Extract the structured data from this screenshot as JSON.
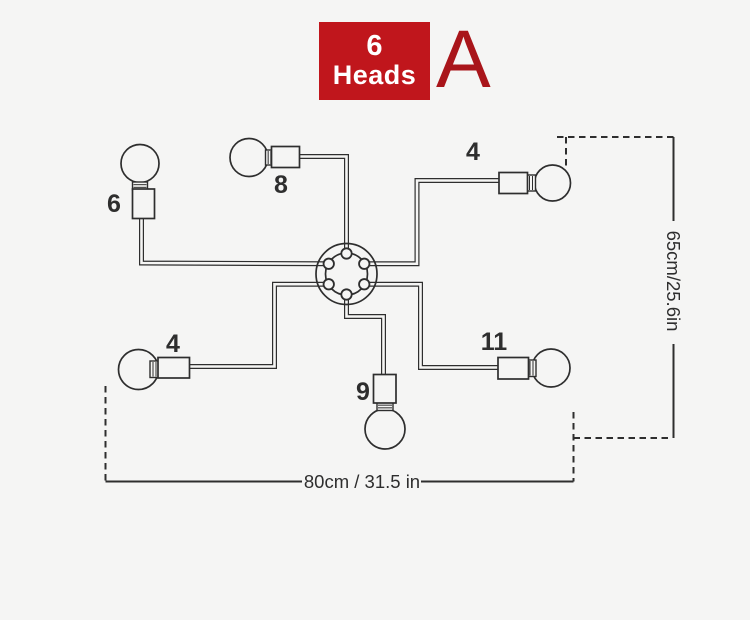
{
  "colors": {
    "background": "#f5f5f4",
    "line": "#2e2e2e",
    "badge_bg": "#c0161c",
    "badge_text": "#ffffff",
    "variant_letter_color": "#a9151a"
  },
  "badge": {
    "count": "6",
    "label": "Heads"
  },
  "variant": {
    "letter": "A"
  },
  "dimensions": {
    "height": {
      "text": "65cm/25.6in"
    },
    "width": {
      "text": "80cm / 31.5 in"
    }
  },
  "diagram": {
    "hub": {
      "cx": 346.5,
      "cy": 274,
      "outer_r": 30.5,
      "inner_r": 21,
      "bolt_ring_r": 20.5,
      "bolt_r": 5.2,
      "bolt_angles_deg": [
        270,
        330,
        30,
        90,
        150,
        210
      ]
    },
    "arms": [
      {
        "label": "6",
        "label_x": 114,
        "label_y": 212,
        "path": [
          [
            141.5,
            217
          ],
          [
            141.5,
            263
          ],
          [
            328.75,
            263.75
          ]
        ],
        "bulb": {
          "cx": 140,
          "cy": 163.5,
          "r": 19
        },
        "neck": {
          "x": 132.5,
          "y": 182,
          "w": 15,
          "h": 8,
          "axis": "v"
        },
        "socket": {
          "x": 132.5,
          "y": 189,
          "w": 22,
          "h": 29.5
        }
      },
      {
        "label": "8",
        "label_x": 281,
        "label_y": 193,
        "path": [
          [
            297,
            156.5
          ],
          [
            346.5,
            156.5
          ],
          [
            346.5,
            253.5
          ]
        ],
        "bulb": {
          "cx": 249,
          "cy": 157.5,
          "r": 19
        },
        "neck": {
          "x": 265.5,
          "y": 150,
          "w": 8,
          "h": 15,
          "axis": "h"
        },
        "socket": {
          "x": 271.5,
          "y": 146.5,
          "w": 28,
          "h": 21
        }
      },
      {
        "label": "4",
        "label_x": 473,
        "label_y": 160,
        "path": [
          [
            364.25,
            263.75
          ],
          [
            417,
            263.75
          ],
          [
            417,
            180.5
          ],
          [
            500,
            180.5
          ]
        ],
        "bulb": {
          "cx": 552.5,
          "cy": 183,
          "r": 18
        },
        "neck": {
          "x": 526.5,
          "y": 175,
          "w": 9,
          "h": 16,
          "axis": "h"
        },
        "socket": {
          "x": 499,
          "y": 172.5,
          "w": 28.5,
          "h": 21
        }
      },
      {
        "label": "11",
        "label_x": 494,
        "label_y": 350,
        "path": [
          [
            364.25,
            284.25
          ],
          [
            420.5,
            284.25
          ],
          [
            420.5,
            367.5
          ],
          [
            499,
            367.5
          ]
        ],
        "bulb": {
          "cx": 551,
          "cy": 368,
          "r": 19
        },
        "neck": {
          "x": 527,
          "y": 360,
          "w": 9,
          "h": 16.5,
          "axis": "h"
        },
        "socket": {
          "x": 498,
          "y": 357.5,
          "w": 30.5,
          "h": 21.5
        }
      },
      {
        "label": "9",
        "label_x": 363,
        "label_y": 400,
        "path": [
          [
            346.5,
            294.5
          ],
          [
            346.5,
            316.5
          ],
          [
            383.5,
            316.5
          ],
          [
            383.5,
            376
          ]
        ],
        "bulb": {
          "cx": 385,
          "cy": 429,
          "r": 20
        },
        "neck": {
          "x": 377,
          "y": 402.5,
          "w": 16,
          "h": 8,
          "axis": "v"
        },
        "socket": {
          "x": 373.5,
          "y": 374.5,
          "w": 22.5,
          "h": 28.5
        }
      },
      {
        "label": "4",
        "label_x": 173,
        "label_y": 352,
        "path": [
          [
            328.75,
            284.25
          ],
          [
            274.5,
            284.25
          ],
          [
            274.5,
            366.5
          ],
          [
            190,
            366.5
          ]
        ],
        "bulb": {
          "cx": 138.5,
          "cy": 369.5,
          "r": 20
        },
        "neck": {
          "x": 150,
          "y": 361,
          "w": 9,
          "h": 16.5,
          "axis": "h"
        },
        "socket": {
          "x": 158,
          "y": 357.5,
          "w": 31.5,
          "h": 20.5
        }
      }
    ],
    "height_dim": {
      "dashed": [
        [
          [
            557,
            137
          ],
          [
            673.5,
            137
          ]
        ],
        [
          [
            566,
            137
          ],
          [
            566,
            168
          ]
        ],
        [
          [
            573.5,
            438
          ],
          [
            672,
            438
          ]
        ],
        [
          [
            573.5,
            412
          ],
          [
            573.5,
            481.5
          ]
        ]
      ],
      "solid": [
        [
          [
            673.5,
            137
          ],
          [
            673.5,
            221
          ]
        ],
        [
          [
            673.5,
            344
          ],
          [
            673.5,
            438
          ]
        ]
      ],
      "text_x": 672,
      "text_y": 281
    },
    "width_dim": {
      "dashed": [
        [
          [
            105.5,
            386
          ],
          [
            105.5,
            481.5
          ]
        ]
      ],
      "solid": [
        [
          [
            105.5,
            481.5
          ],
          [
            302,
            481.5
          ]
        ],
        [
          [
            421,
            481.5
          ],
          [
            573.5,
            481.5
          ]
        ]
      ],
      "text_x": 362,
      "text_y": 488
    }
  }
}
